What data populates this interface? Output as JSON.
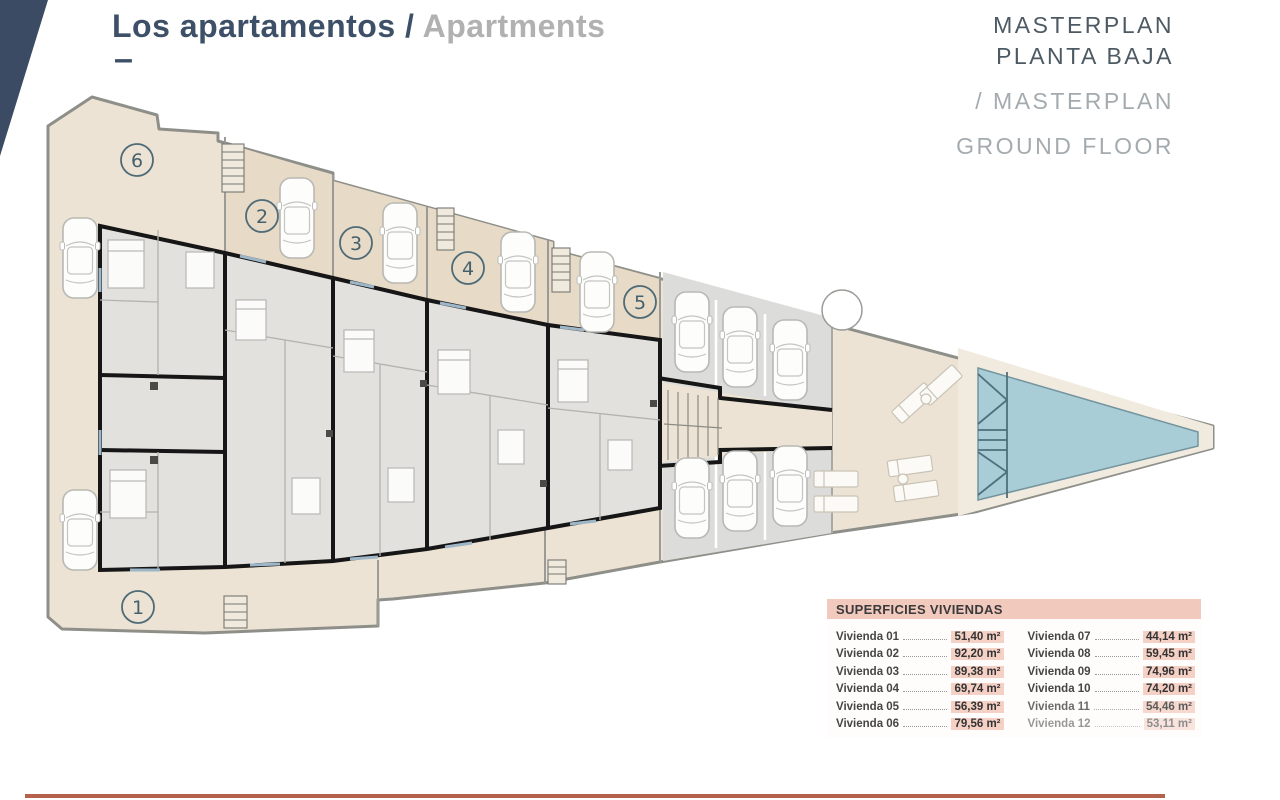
{
  "header": {
    "title_es": "Los apartamentos /",
    "title_en": "Apartments",
    "dash": "–"
  },
  "masterplan_label": {
    "es_line1": "MASTERPLAN",
    "es_line2": "PLANTA BAJA",
    "en_line1": "/ MASTERPLAN",
    "en_line2": "GROUND FLOOR"
  },
  "plan": {
    "units": [
      {
        "number": "1"
      },
      {
        "number": "2"
      },
      {
        "number": "3"
      },
      {
        "number": "4"
      },
      {
        "number": "5"
      },
      {
        "number": "6"
      }
    ],
    "features": [
      "car-icon",
      "stairs-icon",
      "pool",
      "sun-lounger-icon",
      "parking-area"
    ]
  },
  "areas_table": {
    "title": "SUPERFICIES VIVIENDAS",
    "col1": [
      {
        "label": "Vivienda 01",
        "value": "51,40 m²"
      },
      {
        "label": "Vivienda 02",
        "value": "92,20 m²"
      },
      {
        "label": "Vivienda 03",
        "value": "89,38 m²"
      },
      {
        "label": "Vivienda 04",
        "value": "69,74 m²"
      },
      {
        "label": "Vivienda 05",
        "value": "56,39 m²"
      },
      {
        "label": "Vivienda 06",
        "value": "79,56 m²"
      }
    ],
    "col2": [
      {
        "label": "Vivienda 07",
        "value": "44,14 m²"
      },
      {
        "label": "Vivienda 08",
        "value": "59,45 m²"
      },
      {
        "label": "Vivienda 09",
        "value": "74,96 m²"
      },
      {
        "label": "Vivienda 10",
        "value": "74,20 m²"
      },
      {
        "label": "Vivienda 11",
        "value": "54,46 m²"
      },
      {
        "label": "Vivienda 12",
        "value": "53,11 m²"
      }
    ]
  },
  "colors": {
    "accent_navy": "#3d5068",
    "terrace_beige": "#ece3d4",
    "covered_terrace_beige": "#e7dac7",
    "floor_gray": "#e2e1dd",
    "parking_gray": "#dcdcda",
    "pool_teal": "#a9cdd6",
    "table_header_pink": "#f2c9bd",
    "value_highlight_pink": "#f5d0c5",
    "footer_line_terracotta": "#b4624c"
  }
}
